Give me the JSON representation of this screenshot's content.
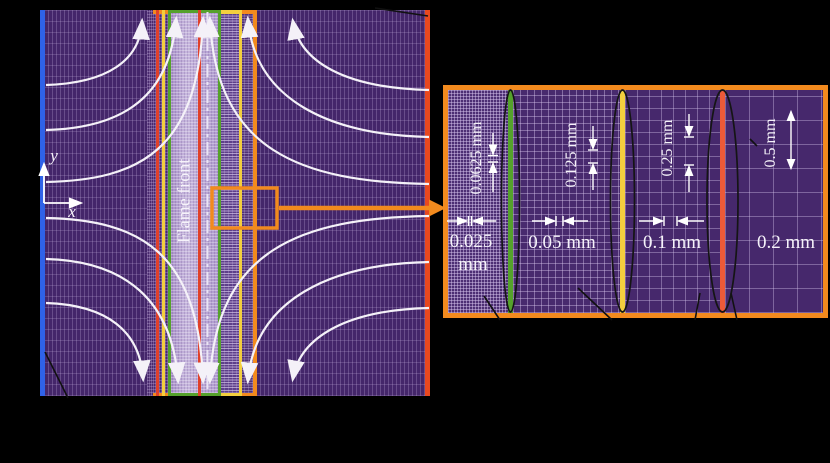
{
  "left_panel": {
    "flame_front_label": "Flame front",
    "y_axis_label": "y",
    "x_axis_label": "x"
  },
  "inset_panel": {
    "regions": [
      {
        "height_label": "0.0625 mm",
        "width_label": "0.025",
        "width_unit": "mm"
      },
      {
        "height_label": "0.125 mm",
        "width_label": "0.05 mm"
      },
      {
        "height_label": "0.25 mm",
        "width_label": "0.1 mm"
      },
      {
        "height_label": "0.5 mm",
        "width_label": "0.2 mm"
      }
    ]
  },
  "colors": {
    "mesh_background": "#44266a",
    "flame_band_lavender": "#beadd8",
    "left_boundary_blue": "#2f62e8",
    "right_boundary_red": "#e8481f",
    "refinement_green": "#55a12c",
    "refinement_yellow": "#f3cf3e",
    "refinement_orange": "#f28a1e",
    "streamline_white": "#f4f1f8"
  }
}
